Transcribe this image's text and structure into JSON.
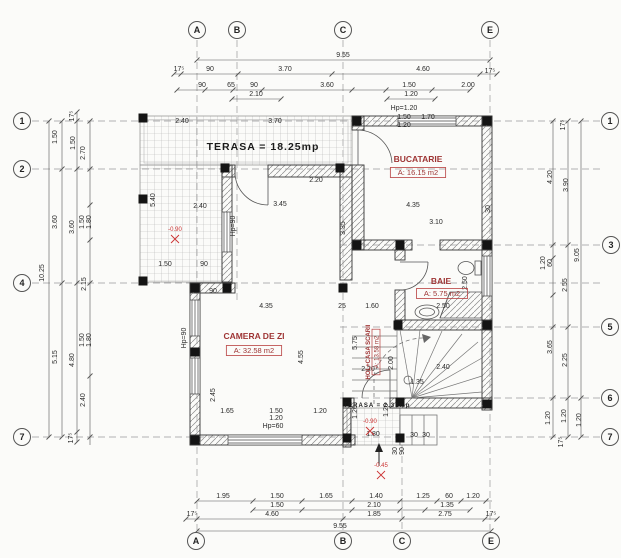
{
  "drawing_type": "architectural floor plan, ground floor",
  "rooms": [
    {
      "id": "terasa",
      "label": "TERASA = 18.25mp",
      "x": 263,
      "y": 150,
      "kind": "black",
      "size": 10.5
    },
    {
      "id": "bucatarie",
      "label": "BUCATARIE",
      "area": "A: 16.15 m2",
      "x": 418,
      "y": 162,
      "ax": 418,
      "ay": 175,
      "kind": "red"
    },
    {
      "id": "baie",
      "label": "BAIE",
      "area": "A: 5.75 m2",
      "x": 441,
      "y": 284,
      "ax": 442,
      "ay": 296,
      "kind": "red"
    },
    {
      "id": "camera-de-zi",
      "label": "CAMERA DE ZI",
      "area": "A: 32.58 m2",
      "x": 254,
      "y": 339,
      "ax": 254,
      "ay": 353,
      "kind": "red"
    },
    {
      "id": "hol-casa-scarii",
      "label": "HOL+CASA SCARII",
      "area": "A: 13.58 m2",
      "x": 370,
      "y": 352,
      "ax": 381,
      "ay": 352,
      "kind": "red-rot"
    },
    {
      "id": "terasa-mica",
      "label": "TERASA = 2.31mp",
      "x": 377,
      "y": 407,
      "kind": "black",
      "size": 6
    }
  ],
  "grid_markers": [
    {
      "side": "top",
      "label": "A",
      "x": 197,
      "y": 30
    },
    {
      "side": "top",
      "label": "B",
      "x": 237,
      "y": 30
    },
    {
      "side": "top",
      "label": "C",
      "x": 343,
      "y": 30
    },
    {
      "side": "top",
      "label": "E",
      "x": 490,
      "y": 30
    },
    {
      "side": "bottom",
      "label": "A",
      "x": 196,
      "y": 541
    },
    {
      "side": "bottom",
      "label": "B",
      "x": 343,
      "y": 541
    },
    {
      "side": "bottom",
      "label": "C",
      "x": 402,
      "y": 541
    },
    {
      "side": "bottom",
      "label": "E",
      "x": 491,
      "y": 541
    },
    {
      "side": "left",
      "label": "1",
      "x": 22,
      "y": 121
    },
    {
      "side": "left",
      "label": "2",
      "x": 22,
      "y": 169
    },
    {
      "side": "left",
      "label": "4",
      "x": 22,
      "y": 283
    },
    {
      "side": "left",
      "label": "7",
      "x": 22,
      "y": 437
    },
    {
      "side": "right",
      "label": "1",
      "x": 610,
      "y": 121
    },
    {
      "side": "right",
      "label": "3",
      "x": 611,
      "y": 245
    },
    {
      "side": "right",
      "label": "5",
      "x": 610,
      "y": 327
    },
    {
      "side": "right",
      "label": "6",
      "x": 610,
      "y": 398
    },
    {
      "side": "right",
      "label": "7",
      "x": 610,
      "y": 437
    }
  ],
  "dimensions": [
    {
      "x": 343,
      "y": 57,
      "t": "9.55"
    },
    {
      "x": 179,
      "y": 71,
      "t": "17⁵"
    },
    {
      "x": 210,
      "y": 71,
      "t": "90"
    },
    {
      "x": 285,
      "y": 71,
      "t": "3.70"
    },
    {
      "x": 423,
      "y": 71,
      "t": "4.60"
    },
    {
      "x": 490,
      "y": 73,
      "t": "17⁵"
    },
    {
      "x": 202,
      "y": 87,
      "t": "90"
    },
    {
      "x": 231,
      "y": 87,
      "t": "65"
    },
    {
      "x": 254,
      "y": 87,
      "t": "90"
    },
    {
      "x": 256,
      "y": 96,
      "t": "2.10"
    },
    {
      "x": 327,
      "y": 87,
      "t": "3.60"
    },
    {
      "x": 409,
      "y": 87,
      "t": "1.50"
    },
    {
      "x": 411,
      "y": 96,
      "t": "1.20"
    },
    {
      "x": 468,
      "y": 87,
      "t": "2.00"
    },
    {
      "x": 223,
      "y": 498,
      "t": "1.95"
    },
    {
      "x": 277,
      "y": 498,
      "t": "1.50"
    },
    {
      "x": 326,
      "y": 498,
      "t": "1.65"
    },
    {
      "x": 376,
      "y": 498,
      "t": "1.40"
    },
    {
      "x": 423,
      "y": 498,
      "t": "1.25"
    },
    {
      "x": 449,
      "y": 498,
      "t": "60"
    },
    {
      "x": 473,
      "y": 498,
      "t": "1.20"
    },
    {
      "x": 277,
      "y": 507,
      "t": "1.50"
    },
    {
      "x": 374,
      "y": 507,
      "t": "2.10"
    },
    {
      "x": 447,
      "y": 507,
      "t": "1.35"
    },
    {
      "x": 192,
      "y": 516,
      "t": "17⁵"
    },
    {
      "x": 272,
      "y": 516,
      "t": "4.60"
    },
    {
      "x": 374,
      "y": 516,
      "t": "1.85"
    },
    {
      "x": 445,
      "y": 516,
      "t": "2.75"
    },
    {
      "x": 491,
      "y": 516,
      "t": "17⁵"
    },
    {
      "x": 340,
      "y": 528,
      "t": "9.55"
    },
    {
      "x": 44,
      "y": 273,
      "t": "10.25",
      "r": 1
    },
    {
      "x": 57,
      "y": 137,
      "t": "1.50",
      "r": 1
    },
    {
      "x": 57,
      "y": 222,
      "t": "3.60",
      "r": 1
    },
    {
      "x": 57,
      "y": 357,
      "t": "5.15",
      "r": 1
    },
    {
      "x": 74,
      "y": 116,
      "t": "17⁵",
      "r": 1
    },
    {
      "x": 75,
      "y": 143,
      "t": "1.50",
      "r": 1
    },
    {
      "x": 74,
      "y": 227,
      "t": "3.60",
      "r": 1
    },
    {
      "x": 74,
      "y": 360,
      "t": "4.80",
      "r": 1
    },
    {
      "x": 73,
      "y": 438,
      "t": "17⁵",
      "r": 1
    },
    {
      "x": 85,
      "y": 153,
      "t": "2.70",
      "r": 1
    },
    {
      "x": 84,
      "y": 222,
      "t": "1.50",
      "r": 1
    },
    {
      "x": 91,
      "y": 222,
      "t": "1.80",
      "r": 1
    },
    {
      "x": 86,
      "y": 284,
      "t": "2.15",
      "r": 1
    },
    {
      "x": 84,
      "y": 340,
      "t": "1.50",
      "r": 1
    },
    {
      "x": 91,
      "y": 340,
      "t": "1.80",
      "r": 1
    },
    {
      "x": 85,
      "y": 400,
      "t": "2.40",
      "r": 1
    },
    {
      "x": 565,
      "y": 125,
      "t": "17⁵",
      "r": 1
    },
    {
      "x": 552,
      "y": 177,
      "t": "4.20",
      "r": 1
    },
    {
      "x": 568,
      "y": 185,
      "t": "3.90",
      "r": 1
    },
    {
      "x": 579,
      "y": 255,
      "t": "9.05",
      "r": 1
    },
    {
      "x": 545,
      "y": 263,
      "t": "1.20",
      "r": 1
    },
    {
      "x": 552,
      "y": 263,
      "t": "60",
      "r": 1
    },
    {
      "x": 567,
      "y": 285,
      "t": "2.55",
      "r": 1
    },
    {
      "x": 552,
      "y": 347,
      "t": "3.65",
      "r": 1
    },
    {
      "x": 567,
      "y": 360,
      "t": "2.25",
      "r": 1
    },
    {
      "x": 550,
      "y": 418,
      "t": "1.20",
      "r": 1
    },
    {
      "x": 566,
      "y": 416,
      "t": "1.20",
      "r": 1
    },
    {
      "x": 581,
      "y": 420,
      "t": "1.20",
      "r": 1
    },
    {
      "x": 563,
      "y": 442,
      "t": "17⁵",
      "r": 1
    },
    {
      "x": 182,
      "y": 123,
      "t": "2.40"
    },
    {
      "x": 275,
      "y": 123,
      "t": "3.70"
    },
    {
      "x": 200,
      "y": 208,
      "t": "2.40"
    },
    {
      "x": 280,
      "y": 206,
      "t": "3.45"
    },
    {
      "x": 345,
      "y": 228,
      "t": "3.35",
      "r": 1
    },
    {
      "x": 155,
      "y": 200,
      "t": "5.40",
      "r": 1
    },
    {
      "x": 165,
      "y": 266,
      "t": "1.50"
    },
    {
      "x": 204,
      "y": 266,
      "t": "90"
    },
    {
      "x": 235,
      "y": 226,
      "t": "Hp=90",
      "r": 1
    },
    {
      "x": 413,
      "y": 207,
      "t": "4.35"
    },
    {
      "x": 436,
      "y": 224,
      "t": "3.10"
    },
    {
      "x": 490,
      "y": 209,
      "t": "30",
      "r": 1
    },
    {
      "x": 404,
      "y": 110,
      "t": "Hp=1.20"
    },
    {
      "x": 404,
      "y": 119,
      "t": "1.50"
    },
    {
      "x": 404,
      "y": 127,
      "t": "1.20"
    },
    {
      "x": 428,
      "y": 119,
      "t": "1.70"
    },
    {
      "x": 316,
      "y": 182,
      "t": "2.20"
    },
    {
      "x": 443,
      "y": 308,
      "t": "2.50"
    },
    {
      "x": 467,
      "y": 283,
      "t": "2.50",
      "r": 1
    },
    {
      "x": 368,
      "y": 371,
      "t": "2.20"
    },
    {
      "x": 393,
      "y": 363,
      "t": "2.00",
      "r": 1
    },
    {
      "x": 443,
      "y": 369,
      "t": "2.40"
    },
    {
      "x": 417,
      "y": 384,
      "t": "1.35"
    },
    {
      "x": 373,
      "y": 436,
      "t": "1.80"
    },
    {
      "x": 414,
      "y": 437,
      "t": "30"
    },
    {
      "x": 426,
      "y": 437,
      "t": "30"
    },
    {
      "x": 397,
      "y": 451,
      "t": "30",
      "r": 1
    },
    {
      "x": 404,
      "y": 451,
      "t": "90",
      "r": 1
    },
    {
      "x": 357,
      "y": 412,
      "t": "1.20",
      "r": 1
    },
    {
      "x": 388,
      "y": 410,
      "t": "1.20",
      "r": 1
    },
    {
      "x": 266,
      "y": 308,
      "t": "4.35"
    },
    {
      "x": 213,
      "y": 293,
      "t": "90"
    },
    {
      "x": 342,
      "y": 308,
      "t": "25"
    },
    {
      "x": 372,
      "y": 308,
      "t": "1.60"
    },
    {
      "x": 303,
      "y": 357,
      "t": "4.55",
      "r": 1
    },
    {
      "x": 357,
      "y": 343,
      "t": "5.75",
      "r": 1
    },
    {
      "x": 227,
      "y": 413,
      "t": "1.65"
    },
    {
      "x": 276,
      "y": 413,
      "t": "1.50"
    },
    {
      "x": 276,
      "y": 420,
      "t": "1.20"
    },
    {
      "x": 320,
      "y": 413,
      "t": "1.20"
    },
    {
      "x": 273,
      "y": 428,
      "t": "Hp=60"
    },
    {
      "x": 215,
      "y": 395,
      "t": "2.45",
      "r": 1
    },
    {
      "x": 186,
      "y": 338,
      "t": "Hp=90",
      "r": 1
    }
  ],
  "level_markers": [
    {
      "x": 175,
      "y": 231,
      "t": "-0.90"
    },
    {
      "x": 370,
      "y": 423,
      "t": "-0.90"
    },
    {
      "x": 381,
      "y": 467,
      "t": "-0.45"
    }
  ]
}
